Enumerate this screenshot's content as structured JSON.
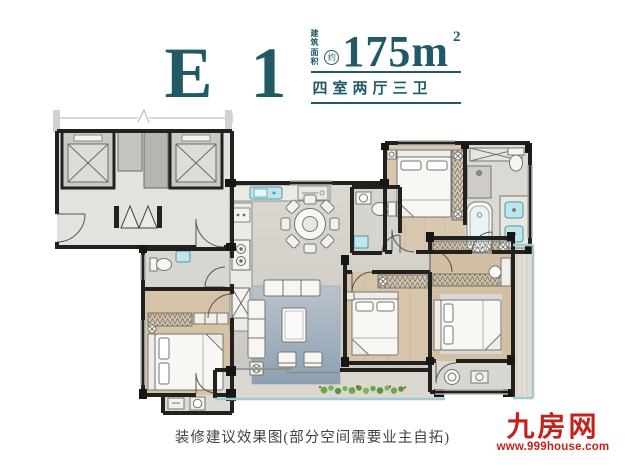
{
  "header": {
    "unit_type": "E 1",
    "area_label_top": "建筑",
    "area_label_bottom": "面积",
    "area_approx": "约",
    "area_value": "175m",
    "area_sup": "2",
    "spec": "四室两厅三卫"
  },
  "caption": {
    "text": "装修建议效果图(部分空间需要业主自拓)"
  },
  "brand": {
    "name": "九房网",
    "site": "www.999house.com"
  },
  "colors": {
    "accent_teal": "#215a64",
    "brand_red": "#c5211c",
    "wall_dark": "#22211e",
    "marble_floor": "#d8d5cf",
    "wood_floor": "#d5c2a7",
    "tile_floor": "#d8d6d1",
    "rug_blue": "#a4b3c2",
    "fixture_teal": "#bfe6ec",
    "plant_green": "#69a845"
  },
  "floorplan": {
    "icons": [
      "elevator-shaft",
      "entry-double-door",
      "kitchen-sink",
      "stove",
      "dining-table",
      "sofa",
      "coffee-table",
      "armchair",
      "bed",
      "wardrobe",
      "bathtub",
      "shower",
      "toilet",
      "washbasin",
      "washing-machine",
      "balcony-plants",
      "window",
      "door-arc"
    ]
  }
}
